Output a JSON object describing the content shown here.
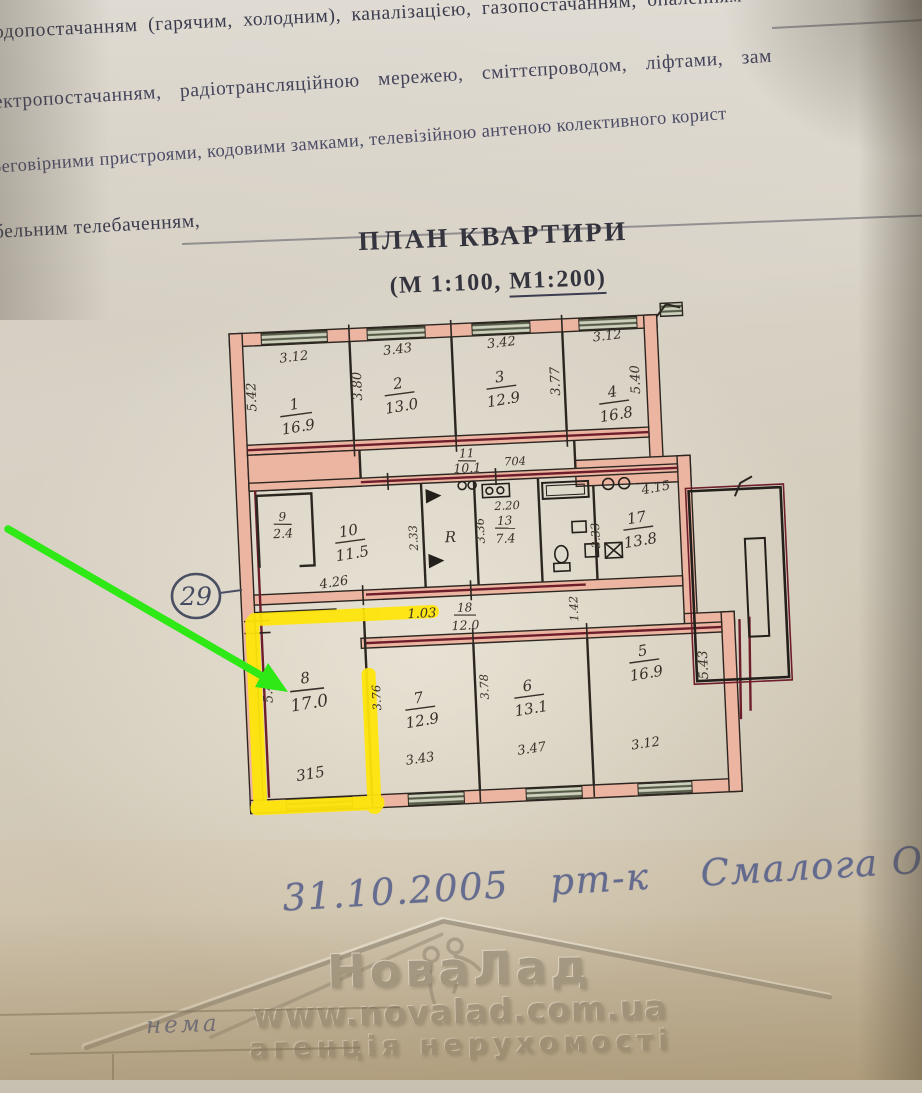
{
  "document": {
    "header_lines": [
      "одопостачанням (гарячим, холодним), каналізацією, газопостачанням, опаленням",
      "ектропостачанням, радіотрансляційною мережею, сміттєпроводом, ліфтами, зам",
      "реговірними пристроями, кодовими замками, телевізійною антеною колективного корист",
      "бельним телебаченням,"
    ],
    "title": "ПЛАН КВАРТИРИ",
    "scale_prefix": "(М 1:100, ",
    "scale_underlined": "М1:200)"
  },
  "plan": {
    "rooms": [
      {
        "number": "1",
        "area": "16.9",
        "width": "3.12",
        "depth": "5.42"
      },
      {
        "number": "2",
        "area": "13.0",
        "width": "3.43",
        "depth": "3.80"
      },
      {
        "number": "3",
        "area": "12.9",
        "width": "3.42",
        "depth": "3.77"
      },
      {
        "number": "4",
        "area": "16.8",
        "width": "3.12",
        "depth": "5.40"
      },
      {
        "number": "5",
        "area": "16.9",
        "width": "3.12",
        "depth": "5.43"
      },
      {
        "number": "6",
        "area": "13.1",
        "width": "3.47",
        "depth": "3.78"
      },
      {
        "number": "7",
        "area": "12.9",
        "width": "3.43",
        "depth": "3.76"
      },
      {
        "number": "8",
        "area": "17.0",
        "width": "315",
        "depth": "5.40"
      },
      {
        "number": "9",
        "area": "2.4"
      },
      {
        "number": "10",
        "area": "11.5",
        "width": "4.26",
        "depth": "2.33"
      },
      {
        "number": "11",
        "area": "10.1",
        "width": "704"
      },
      {
        "number": "13",
        "area": "7.4",
        "width": "2.20",
        "depth": "3.36"
      },
      {
        "number": "17",
        "area": "13.8",
        "width": "4.15",
        "depth": "3.33"
      },
      {
        "number": "18",
        "area": "12.0",
        "width": "1.03",
        "depth": "1.42"
      }
    ],
    "riser_label": "R",
    "apartment_mark": "29"
  },
  "handwriting": {
    "date": "31.10.2005",
    "abbrev": "рт-к",
    "name": "Смалога О.А.",
    "form_value": "нема"
  },
  "watermark": {
    "brand": "НоваЛад",
    "url": "www.novalad.com.ua",
    "tagline": "агенція нерухомості"
  },
  "colors": {
    "highlight_yellow": "#ffe50a",
    "arrow_green": "#2ee915",
    "wall_pink": "#ecb5a2",
    "wall_maroon": "#6e1e2b",
    "ink_blue": "#41508a"
  }
}
